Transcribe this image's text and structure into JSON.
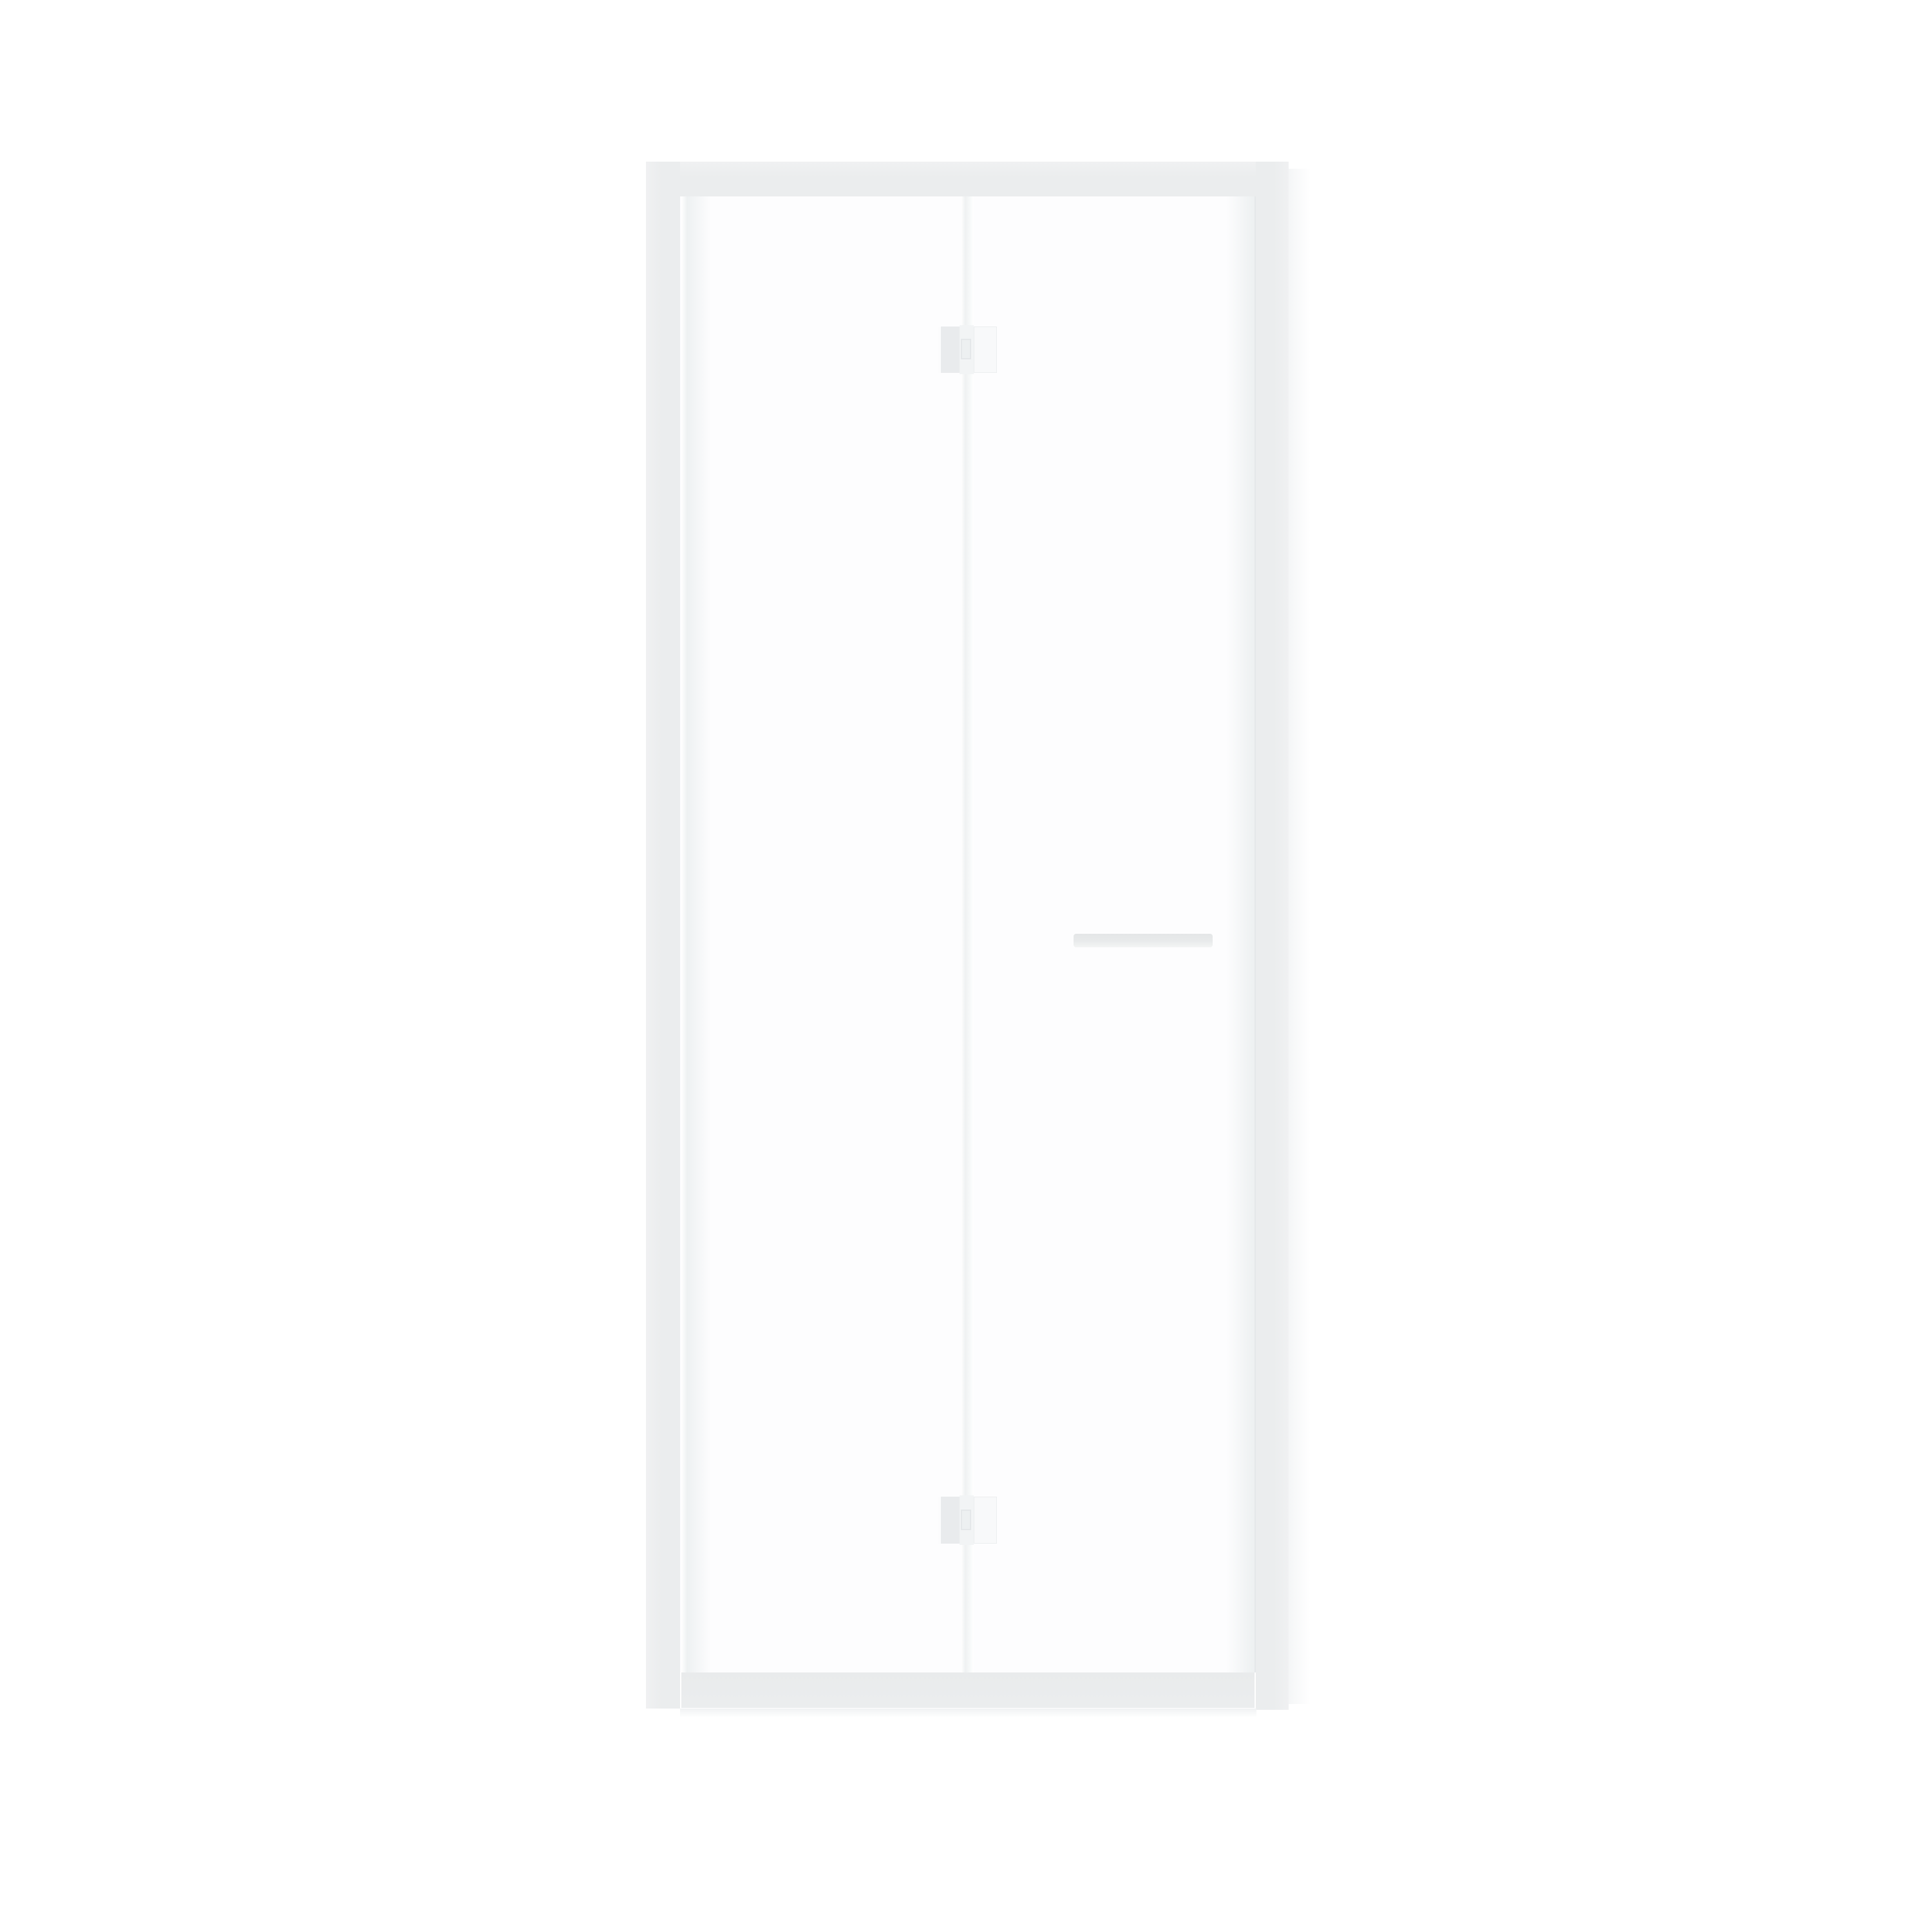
{
  "scene": {
    "description": "Product photo of a white-framed bi-fold shower door with two clear glass panels, fold hinges at top and bottom of the central fold line, and a horizontal handle bar on the right panel, centered on a plain white background",
    "background_color": "#ffffff",
    "text_content": "none"
  },
  "parts": [
    "frame-top-rail",
    "frame-left-jamb",
    "frame-right-jamb",
    "frame-bottom-sill",
    "glass-panel-left",
    "glass-panel-right",
    "fold-line",
    "fold-hinge-top",
    "fold-hinge-bottom",
    "handle-bar"
  ],
  "colors": {
    "background": "#ffffff",
    "frame": "#ebedee",
    "frame_light": "#f0f1f2",
    "sill": "#e9ebec",
    "glass": "#fdfdfe",
    "glass_edge": "#eef1f2",
    "edge_line": "#e4e7e9",
    "fold_line": "#eff1f2",
    "hinge_left_plate": "#e9ebed",
    "hinge_knuckle": "#f2f4f5",
    "hinge_right_plate": "#f8f9fa",
    "handle": "#e8eaeb",
    "shadow": "#f0f2f3"
  }
}
